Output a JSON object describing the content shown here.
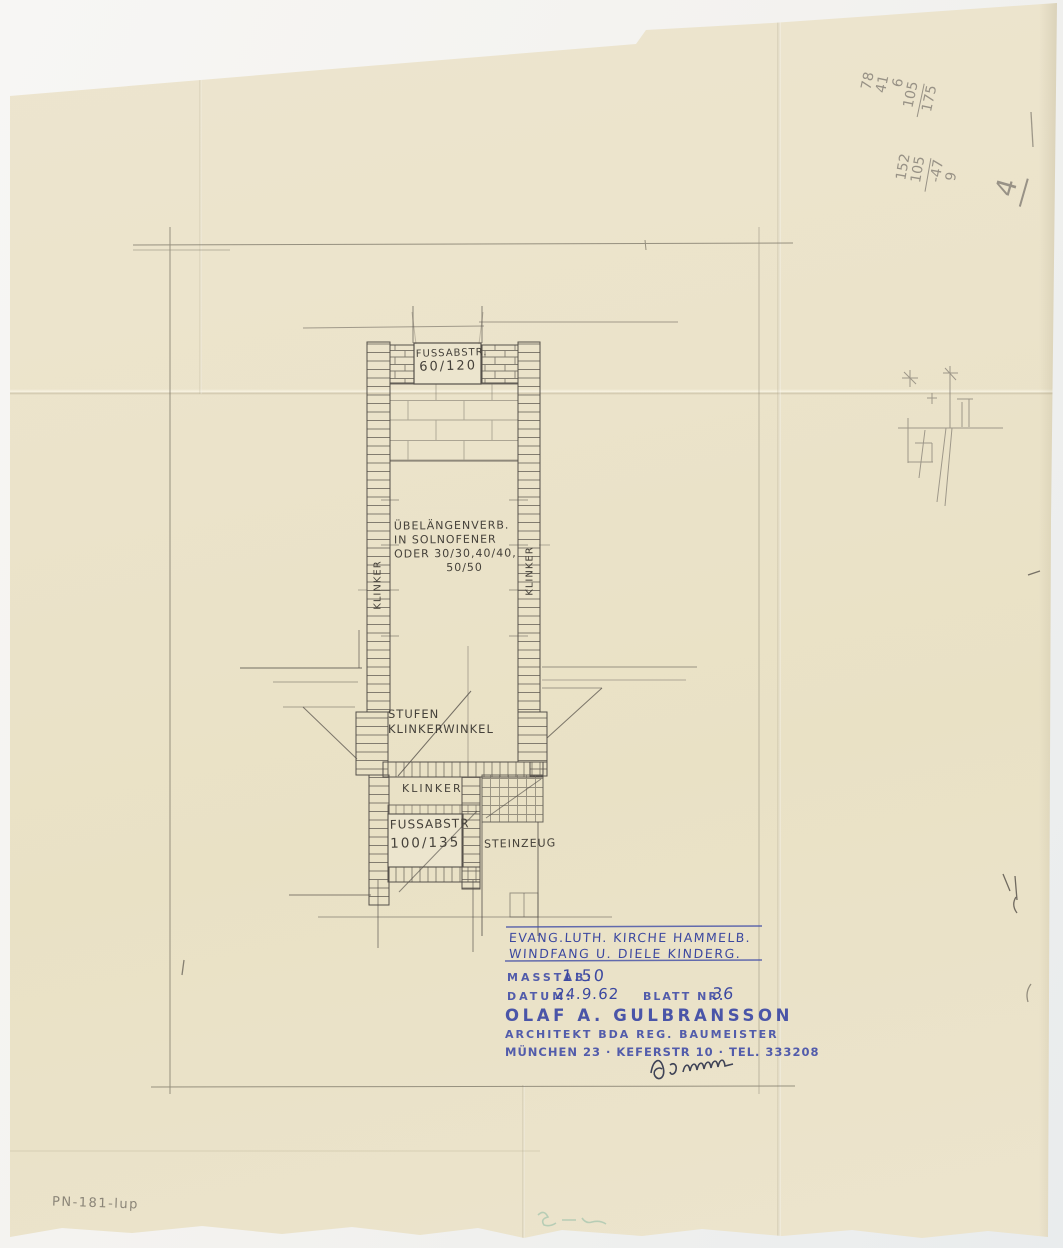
{
  "plan": {
    "mat_top": {
      "line1": "FUSSABSTR.",
      "line2": "60/120"
    },
    "note": {
      "line1": "ÜBELÄNGENVERB.",
      "line2": "IN SOLNOFENER",
      "line3": "ODER 30/30,40/40,",
      "line4": "50/50"
    },
    "klinker_left": "KLINKER",
    "klinker_right": "KLINKER",
    "stufen": {
      "line1": "STUFEN",
      "line2": "KLINKERWINKEL"
    },
    "klinker_bottom": "KLINKER",
    "mat_bottom": {
      "line1": "FUSSABSTR",
      "line2": "100/135"
    },
    "steinzeug": "STEINZEUG"
  },
  "annotations": {
    "calc_a": [
      "78",
      "41",
      "6",
      "105",
      "175"
    ],
    "calc_b": [
      "152",
      "105",
      "-47",
      "9"
    ],
    "calc_mark": "4",
    "inventory": "PN-181-lup"
  },
  "title_block": {
    "project_line1": "EVANG.LUTH. KIRCHE HAMMELB.",
    "project_line2": "WINDFANG U. DIELE KINDERG.",
    "masstab_label": "MASSTAB:",
    "masstab_value": "1:50",
    "datum_label": "DATUM:",
    "datum_value": "24.9.62",
    "blatt_label": "BLATT NR.",
    "blatt_value": "36",
    "architect_name": "OLAF A. GULBRANSSON",
    "architect_title": "ARCHITEKT BDA REG. BAUMEISTER",
    "architect_address": "MÜNCHEN 23 · KEFERSTR 10 · TEL. 333208"
  },
  "colors": {
    "ink_blue": "#3c48a0",
    "pencil": "#45413a",
    "paper": "#ebe3ca"
  }
}
